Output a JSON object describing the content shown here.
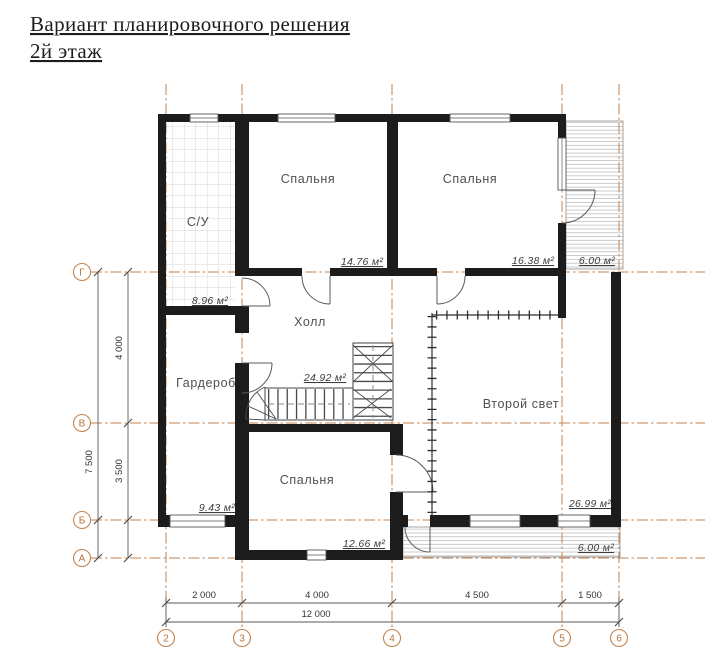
{
  "title": {
    "line1": "Вариант планировочного решения",
    "line2": "2й этаж"
  },
  "rooms": {
    "su": {
      "label": "С/У",
      "area": "8.96 м²"
    },
    "bedroom_top_left": {
      "label": "Спальня",
      "area": "14.76 м²"
    },
    "bedroom_top_right": {
      "label": "Спальня",
      "area": "16.38 м²"
    },
    "balcony_top": {
      "area": "6.00 м²"
    },
    "hall": {
      "label": "Холл",
      "area": "24.92 м²"
    },
    "wardrobe": {
      "label": "Гардероб",
      "area": "9.43 м²"
    },
    "second_light": {
      "label": "Второй свет",
      "area": "26.99 м²"
    },
    "bedroom_bottom": {
      "label": "Спальня",
      "area": "12.66 м²"
    },
    "balcony_bottom": {
      "area": "6.00 м²"
    }
  },
  "axes": {
    "rows": [
      {
        "label": "Г"
      },
      {
        "label": "В"
      },
      {
        "label": "Б"
      },
      {
        "label": "А"
      }
    ],
    "cols": [
      {
        "label": "2"
      },
      {
        "label": "3"
      },
      {
        "label": "4"
      },
      {
        "label": "5"
      },
      {
        "label": "6"
      }
    ]
  },
  "dimensions": {
    "left": {
      "seg_g_v": "4 000",
      "seg_v_b": "3 500",
      "total": "7 500"
    },
    "bottom": {
      "seg_2_3": "2 000",
      "seg_3_4": "4 000",
      "seg_4_5": "4 500",
      "seg_5_6": "1 500",
      "total": "12 000"
    }
  },
  "colors": {
    "axis_grid": "#c2834f",
    "walls": "#1c1c1c",
    "background": "#ffffff"
  }
}
